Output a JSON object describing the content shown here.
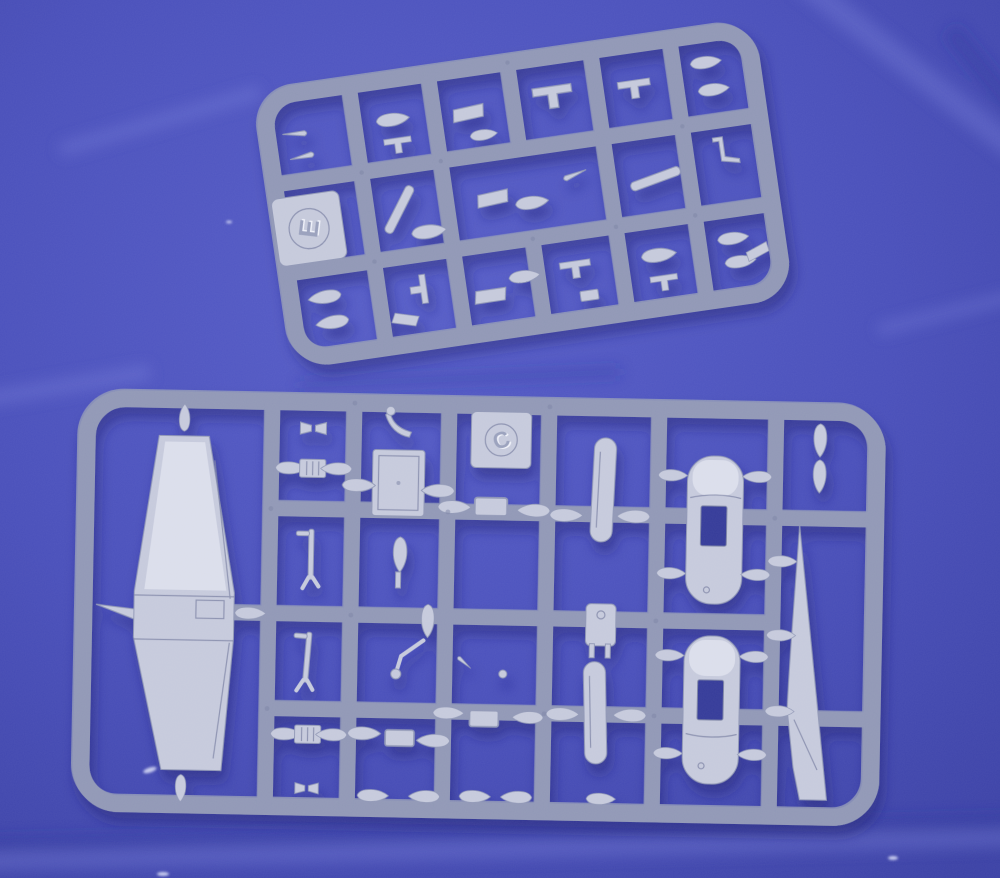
{
  "scene": {
    "description": "Photograph of two light-grey injection-moulded plastic model kit sprues (runner frames with aircraft parts) lying on creased blue fabric",
    "sprue_top": {
      "tag_letter": "E",
      "contents": "small detail parts: bombs, drop tanks, doors, stabilisers, struts"
    },
    "sprue_bottom": {
      "tag_letter": "C",
      "contents": "one-piece wing, two fuselage halves, tail fin, drop tanks, landing gear legs, hatch panels"
    }
  },
  "colors": {
    "fabric_base": "#4a50bb",
    "fabric_light": "#6b71d6",
    "fabric_dark": "#343a99",
    "plastic_base": "#c6cadc",
    "plastic_light": "#edeff7",
    "plastic_mid": "#aeb4cb",
    "plastic_shadow": "#9198b6",
    "plastic_deep": "#7e85a6",
    "cast_shadow": "#1b2070"
  }
}
